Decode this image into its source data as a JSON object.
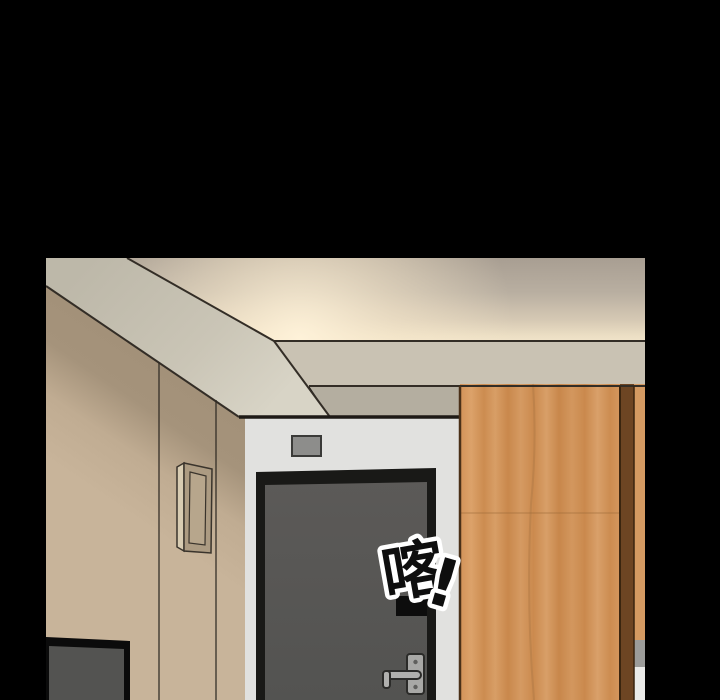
{
  "caption": {
    "line1": "然后...再把最后",
    "line2": "仅剩的食物残渣留给我舔"
  },
  "sfx": {
    "knock": "喀",
    "exclamation": "!"
  },
  "palette": {
    "page_background": "#000000",
    "ceiling_top": "#a89e92",
    "ceiling_glow": "#f2e5ca",
    "soffit_band": "#c9c4b5",
    "soffit_fascia": "#c9c2b3",
    "wall_shadow": "#a29078",
    "wall": "#c2ae94",
    "door_surround": "#e1e1df",
    "door_frame": "#191917",
    "door": "#575755",
    "door_sign": "#8d8d8b",
    "handle_metal": "#a8a8a6",
    "wood_panel": "#d0925a",
    "wood_divider": "#6d4523",
    "tv_frame": "#0b0b0b",
    "tv_screen": "#535351",
    "sfx_fill": "#0e0e0e",
    "sfx_outline": "#ffffff"
  }
}
